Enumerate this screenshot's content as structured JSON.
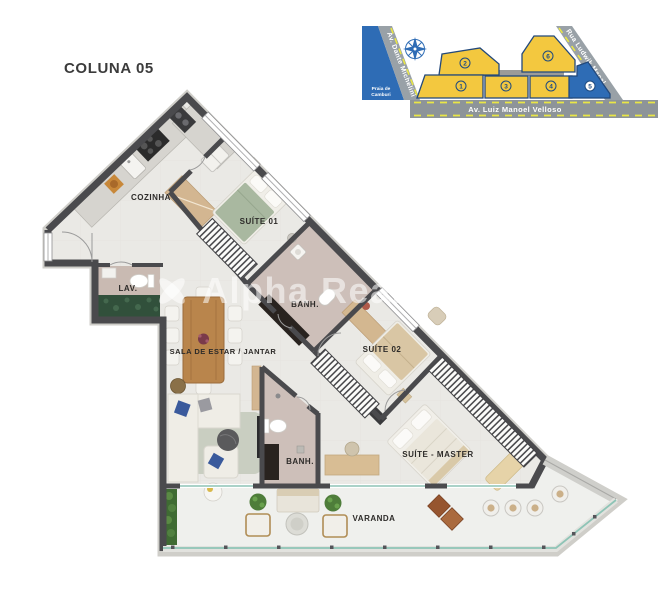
{
  "title": "COLUNA 05",
  "watermark": {
    "text": "Alpha Realty"
  },
  "floor_plan": {
    "rooms": [
      {
        "id": "cozinha",
        "label": "COZINHA"
      },
      {
        "id": "suite-01",
        "label": "SUÍTE 01"
      },
      {
        "id": "lav",
        "label": "LAV."
      },
      {
        "id": "banh-suite-01",
        "label": "BANH."
      },
      {
        "id": "sala",
        "label": "SALA DE ESTAR / JANTAR"
      },
      {
        "id": "suite-02",
        "label": "SUÍTE 02"
      },
      {
        "id": "banh-social",
        "label": "BANH."
      },
      {
        "id": "suite-master",
        "label": "SUÍTE - MASTER"
      },
      {
        "id": "varanda",
        "label": "VARANDA"
      }
    ],
    "colors": {
      "wall": "#4a4a4d",
      "floor": "#eae9e5",
      "balcony_floor": "#eff0ed",
      "bath_floor": "#cdbfb9",
      "bed_green": "#a9b8a0",
      "wood": "#b9854c",
      "glass_rail": "#8ec4b6"
    }
  },
  "site_map": {
    "streets": [
      {
        "name": "Av. Dante Michelini"
      },
      {
        "name": "Rua Ludwik Macal"
      },
      {
        "name": "Av. Luiz Manoel Velloso"
      }
    ],
    "landmark_lines": [
      "Praia de",
      "Camburi"
    ],
    "buildings": [
      {
        "number": "1",
        "highlighted": false
      },
      {
        "number": "2",
        "highlighted": false
      },
      {
        "number": "3",
        "highlighted": false
      },
      {
        "number": "4",
        "highlighted": false
      },
      {
        "number": "5",
        "highlighted": true
      },
      {
        "number": "6",
        "highlighted": false
      }
    ],
    "colors": {
      "building": "#f3c83f",
      "highlight": "#2e6cb5",
      "street": "#99a1a7",
      "dash": "#e9e645",
      "outline": "#23497b"
    }
  }
}
